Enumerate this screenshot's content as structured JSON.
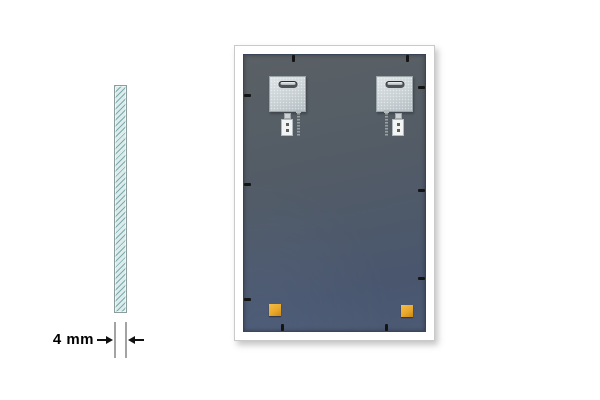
{
  "cross_section": {
    "dimension_label": "4 mm",
    "glass_fill_color": "#dcebeb",
    "hatch_color": "#6ca0a0",
    "border_color": "#8d9c9c",
    "extension_line_color": "#a3a3a3",
    "arrow_color": "#111111"
  },
  "mirror_back": {
    "frame_color": "#ffffff",
    "frame_outline_color": "#c9c9c9",
    "panel_color_top": "#5a6065",
    "panel_color_bottom": "#4c5a74",
    "bracket_color": "#ccd4d8",
    "bracket_slot_color": "#4e5357",
    "wall_anchor_color": "#f3f5f5",
    "screw_color": "#5d6468",
    "clip_color": "#141414",
    "corner_pad_color": "#e9a82b",
    "bracket_count": 2,
    "hardware_set_count": 2,
    "corner_pad_count": 2,
    "clip_count": 10
  }
}
